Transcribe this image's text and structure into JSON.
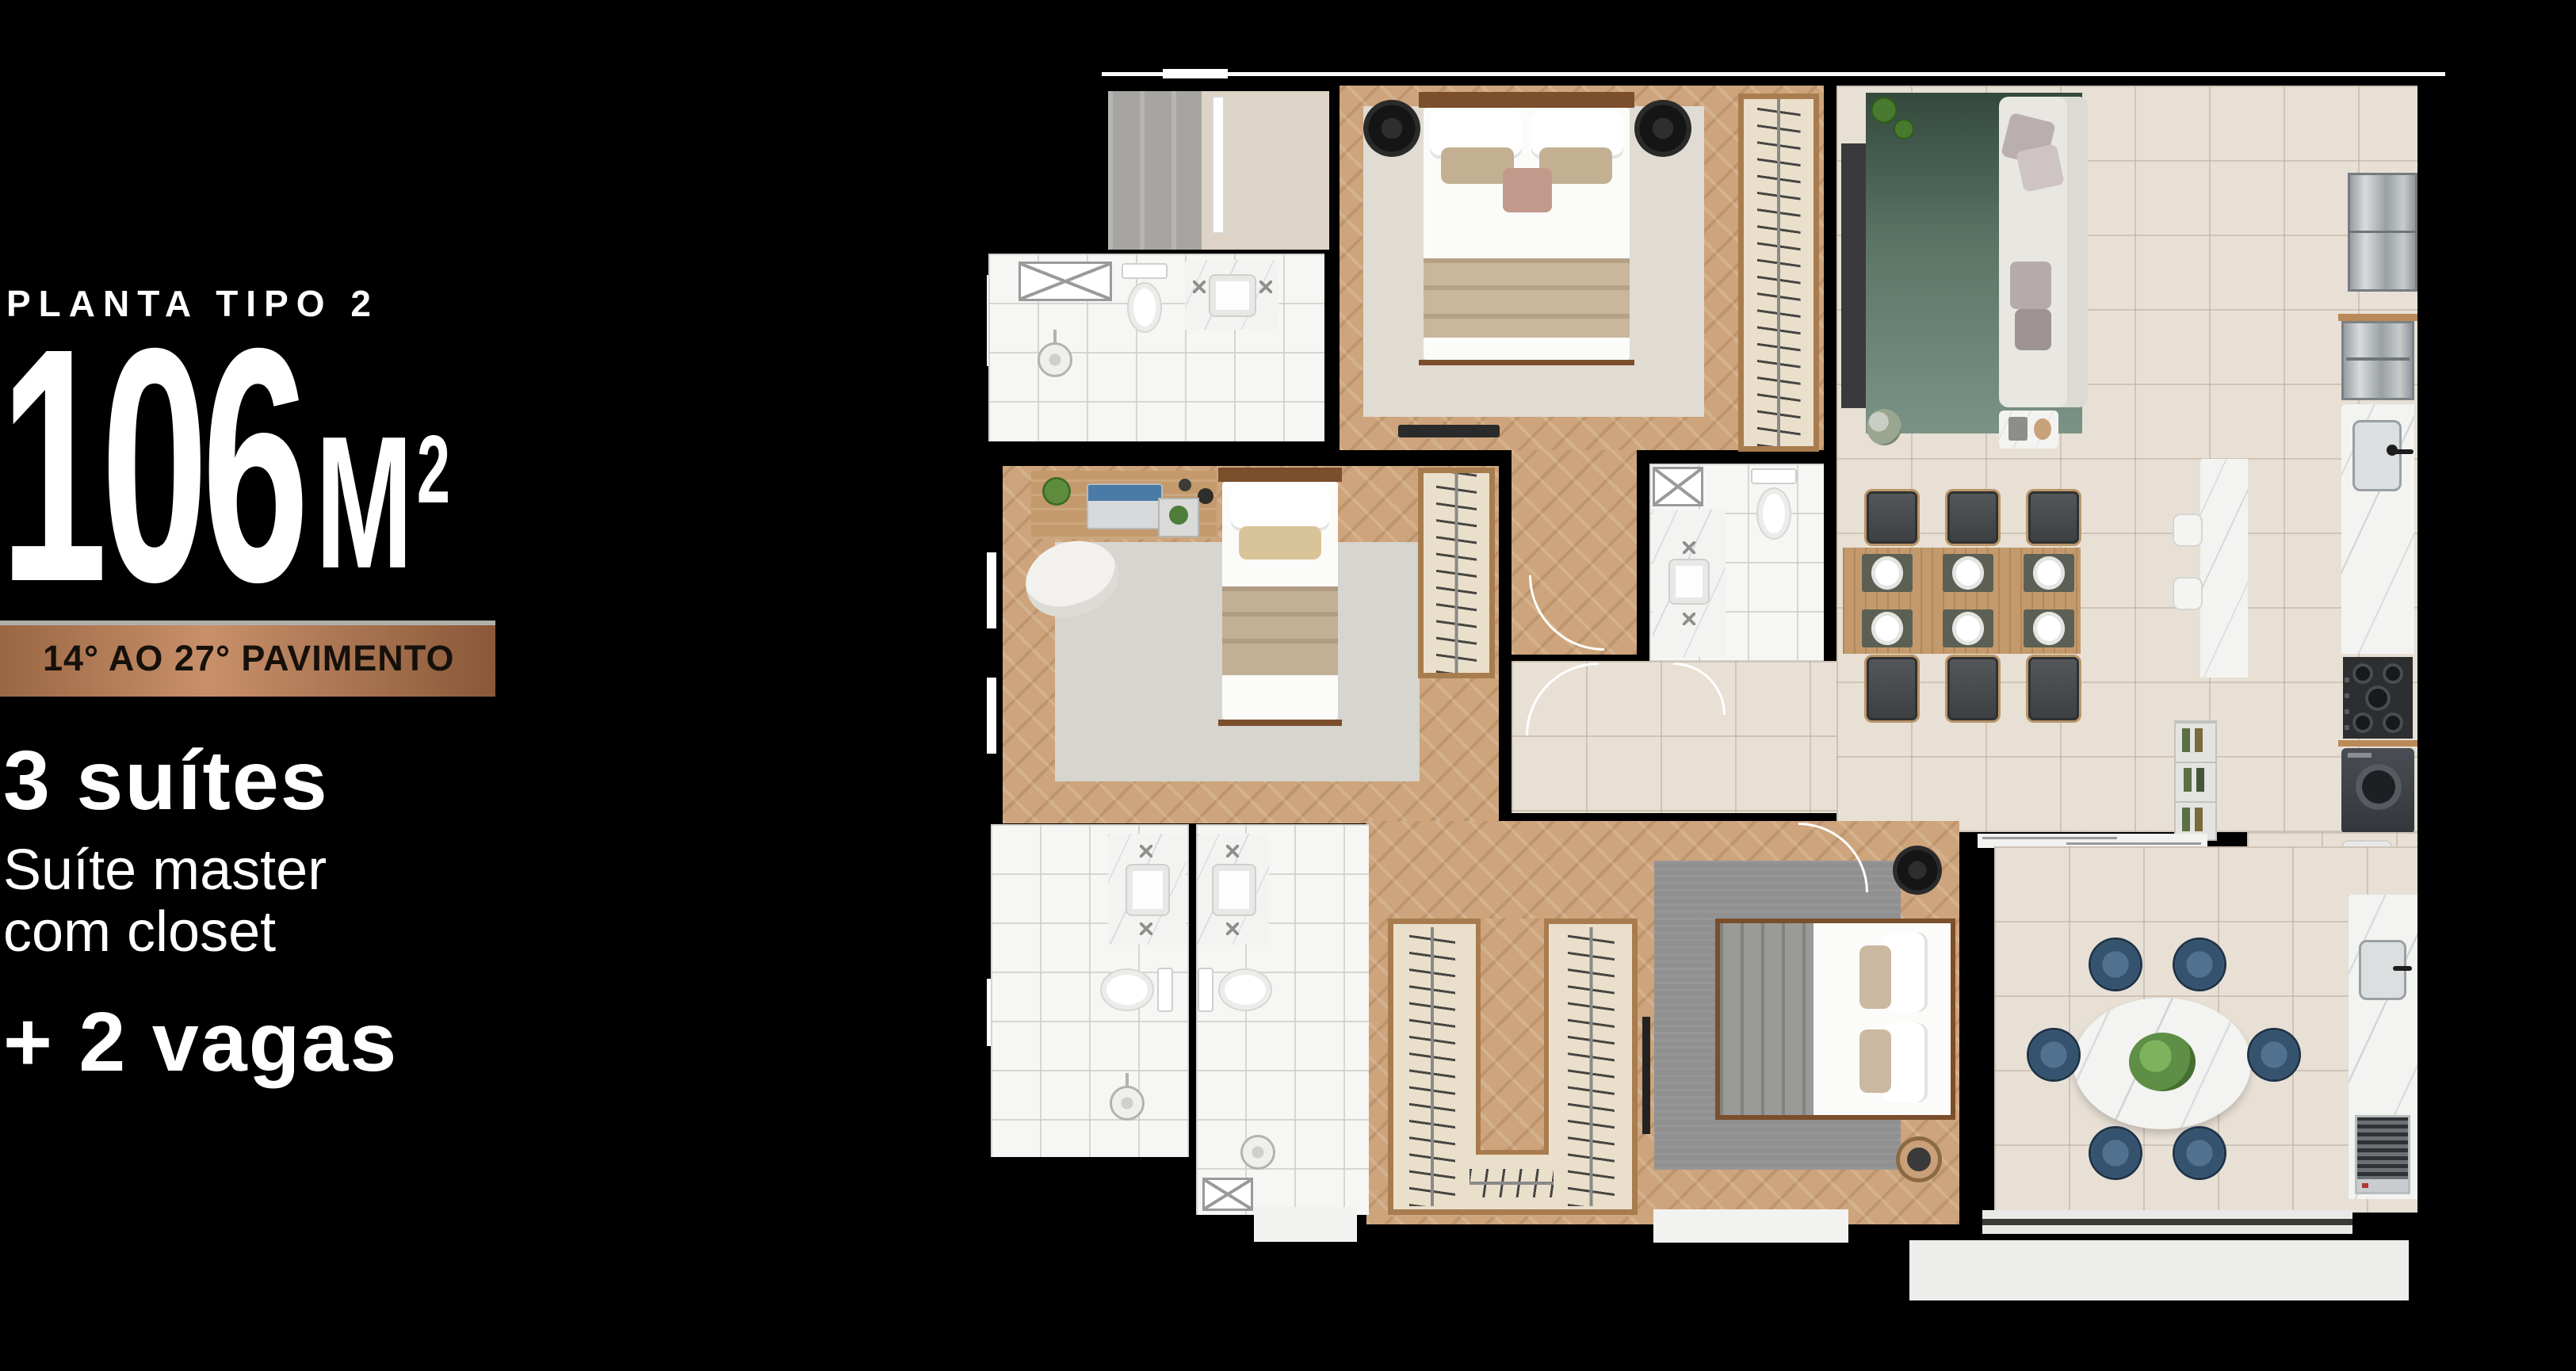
{
  "palette": {
    "bg": "#000000",
    "text": "#ffffff",
    "copper_dark": "#9a6743",
    "copper_light": "#c8906a",
    "copper_deep": "#8a5838",
    "badge_text": "#16100b",
    "wood": "#cda47b",
    "tile": "#e8e0d5",
    "bath_tile": "#f6f6f4",
    "marble_base": "#f3f3f1",
    "green_rug": "#5b7567",
    "blue_chair": "#35536e",
    "closet": "#eadfcb",
    "wood_trim": "#a87c4f"
  },
  "info": {
    "plan_label": "PLANTA TIPO 2",
    "area_value": "106",
    "area_unit": "M",
    "area_exponent": "2",
    "floor_badge": "14° AO 27° PAVIMENTO",
    "features": [
      {
        "text": "3 suítes",
        "weight": "bold"
      },
      {
        "text": "Suíte master",
        "weight": "regular"
      },
      {
        "text": "com closet",
        "weight": "regular"
      },
      {
        "text": "+ 2 vagas",
        "weight": "bold"
      }
    ]
  },
  "floor_plan": {
    "type": "apartment-floor-plan-top-view",
    "rooms": [
      "entry-hall",
      "suite-2-bedroom",
      "suite-2-bathroom",
      "suite-3-bedroom",
      "suite-3-bathroom",
      "hallway",
      "living-room",
      "dining-area",
      "kitchen",
      "laundry",
      "master-suite",
      "master-closet",
      "master-bathroom-1",
      "master-bathroom-2",
      "gourmet-balcony"
    ]
  }
}
